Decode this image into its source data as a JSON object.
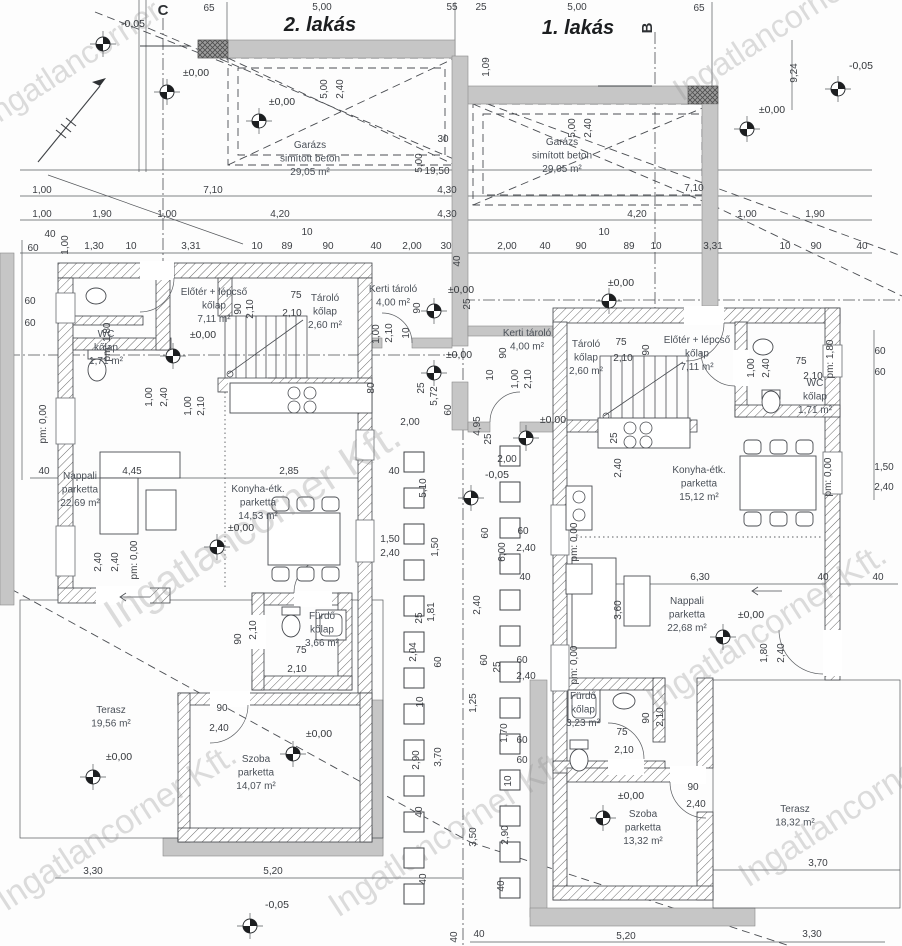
{
  "drawing": {
    "watermark_text": "Ingatlancorner Kft.",
    "units": [
      {
        "label": "2. lakás",
        "x": 320,
        "y": 31
      },
      {
        "label": "1. lakás",
        "x": 578,
        "y": 34
      }
    ],
    "section_markers": [
      {
        "t": "C",
        "x": 163,
        "y": 15,
        "r": 0,
        "line": [
          140,
          46,
          190,
          46
        ]
      },
      {
        "t": "B",
        "x": 652,
        "y": 28,
        "r": -90,
        "line": [
          598,
          86,
          652,
          86
        ]
      }
    ]
  },
  "rooms": [
    {
      "lines": [
        "Garázs",
        "simított beton",
        "29,05 m²"
      ],
      "x": 310,
      "y": 148
    },
    {
      "lines": [
        "Garázs",
        "simított beton",
        "29,05 m²"
      ],
      "x": 562,
      "y": 145
    },
    {
      "lines": [
        "Előtér + lépcső",
        "kőlap",
        "7,11 m²"
      ],
      "x": 214,
      "y": 295
    },
    {
      "lines": [
        "Előtér + lépcső",
        "kőlap",
        "7,11 m²"
      ],
      "x": 697,
      "y": 343
    },
    {
      "lines": [
        "WC",
        "kőlap",
        "1,71 m²"
      ],
      "x": 106,
      "y": 337
    },
    {
      "lines": [
        "WC",
        "kőlap",
        "1,71 m²"
      ],
      "x": 815,
      "y": 386
    },
    {
      "lines": [
        "Tároló",
        "kőlap",
        "2,60 m²"
      ],
      "x": 325,
      "y": 301
    },
    {
      "lines": [
        "Tároló",
        "kőlap",
        "2,60 m²"
      ],
      "x": 586,
      "y": 347
    },
    {
      "lines": [
        "Kerti tároló",
        "4,00 m²"
      ],
      "x": 393,
      "y": 292
    },
    {
      "lines": [
        "Kerti tároló",
        "4,00 m²"
      ],
      "x": 527,
      "y": 336
    },
    {
      "lines": [
        "Konyha-étk.",
        "parketta",
        "14,53 m²"
      ],
      "x": 258,
      "y": 492
    },
    {
      "lines": [
        "Konyha-étk.",
        "parketta",
        "15,12 m²"
      ],
      "x": 699,
      "y": 473
    },
    {
      "lines": [
        "Nappali",
        "parketta",
        "22,69 m²"
      ],
      "x": 80,
      "y": 479
    },
    {
      "lines": [
        "Nappali",
        "parketta",
        "22,68 m²"
      ],
      "x": 687,
      "y": 604
    },
    {
      "lines": [
        "Fürdő",
        "kőlap",
        "3,66 m²"
      ],
      "x": 322,
      "y": 619
    },
    {
      "lines": [
        "Fürdő",
        "kőlap",
        "3,23 m²"
      ],
      "x": 583,
      "y": 699
    },
    {
      "lines": [
        "Szoba",
        "parketta",
        "14,07 m²"
      ],
      "x": 256,
      "y": 762
    },
    {
      "lines": [
        "Szoba",
        "parketta",
        "13,32 m²"
      ],
      "x": 643,
      "y": 817
    },
    {
      "lines": [
        "Terasz",
        "19,56 m²"
      ],
      "x": 111,
      "y": 713
    },
    {
      "lines": [
        "Terasz",
        "18,32 m²"
      ],
      "x": 795,
      "y": 812
    }
  ],
  "levels": [
    {
      "t": "-0,05",
      "lx": 133,
      "ly": 27,
      "mx": 103,
      "my": 44
    },
    {
      "t": "±0,00",
      "lx": 196,
      "ly": 76,
      "mx": 167,
      "my": 92
    },
    {
      "t": "±0,00",
      "lx": 282,
      "ly": 105,
      "mx": 259,
      "my": 121
    },
    {
      "t": "±0,00",
      "lx": 772,
      "ly": 113,
      "mx": 747,
      "my": 129
    },
    {
      "t": "-0,05",
      "lx": 861,
      "ly": 69,
      "mx": 838,
      "my": 89
    },
    {
      "t": "±0,00",
      "lx": 621,
      "ly": 286,
      "mx": 609,
      "my": 301
    },
    {
      "t": "±0,00",
      "lx": 203,
      "ly": 338,
      "mx": 173,
      "my": 356
    },
    {
      "t": "±0,00",
      "lx": 461,
      "ly": 293,
      "mx": 434,
      "my": 311
    },
    {
      "t": "±0,00",
      "lx": 459,
      "ly": 358,
      "mx": 434,
      "my": 373
    },
    {
      "t": "±0,00",
      "lx": 553,
      "ly": 423,
      "mx": 526,
      "my": 438
    },
    {
      "t": "-0,05",
      "lx": 497,
      "ly": 478,
      "mx": 471,
      "my": 498
    },
    {
      "t": "±0,00",
      "lx": 241,
      "ly": 531,
      "mx": 217,
      "my": 547
    },
    {
      "t": "±0,00",
      "lx": 751,
      "ly": 618,
      "mx": 723,
      "my": 637
    },
    {
      "t": "±0,00",
      "lx": 319,
      "ly": 737,
      "mx": 293,
      "my": 754
    },
    {
      "t": "±0,00",
      "lx": 119,
      "ly": 760,
      "mx": 93,
      "my": 777
    },
    {
      "t": "±0,00",
      "lx": 631,
      "ly": 799,
      "mx": 603,
      "my": 818
    },
    {
      "t": "-0,05",
      "lx": 277,
      "ly": 908,
      "mx": 250,
      "my": 926
    }
  ],
  "dims": [
    {
      "t": "65",
      "x": 209,
      "y": 11
    },
    {
      "t": "5,00",
      "x": 322,
      "y": 10
    },
    {
      "t": "55",
      "x": 452,
      "y": 10
    },
    {
      "t": "25",
      "x": 481,
      "y": 10
    },
    {
      "t": "5,00",
      "x": 577,
      "y": 10
    },
    {
      "t": "65",
      "x": 699,
      "y": 11
    },
    {
      "t": "1,09",
      "x": 489,
      "y": 67,
      "r": 1
    },
    {
      "t": "9,24",
      "x": 797,
      "y": 73,
      "r": 1
    },
    {
      "t": "5,00",
      "x": 327,
      "y": 89,
      "r": 1
    },
    {
      "t": "2,40",
      "x": 343,
      "y": 89,
      "r": 1
    },
    {
      "t": "5,00",
      "x": 575,
      "y": 128,
      "r": 1
    },
    {
      "t": "2,40",
      "x": 591,
      "y": 128,
      "r": 1
    },
    {
      "t": "30",
      "x": 443,
      "y": 142
    },
    {
      "t": "5,00",
      "x": 422,
      "y": 163,
      "r": 1
    },
    {
      "t": "19,50",
      "x": 437,
      "y": 174
    },
    {
      "t": "40",
      "x": 460,
      "y": 261,
      "r": 1
    },
    {
      "t": "1,00",
      "x": 42,
      "y": 193
    },
    {
      "t": "7,10",
      "x": 213,
      "y": 193
    },
    {
      "t": "4,30",
      "x": 447,
      "y": 193
    },
    {
      "t": "7,10",
      "x": 694,
      "y": 191
    },
    {
      "t": "1,00",
      "x": 42,
      "y": 217
    },
    {
      "t": "1,90",
      "x": 102,
      "y": 217
    },
    {
      "t": "1,00",
      "x": 167,
      "y": 217
    },
    {
      "t": "4,20",
      "x": 280,
      "y": 217
    },
    {
      "t": "4,30",
      "x": 447,
      "y": 217
    },
    {
      "t": "4,20",
      "x": 637,
      "y": 217
    },
    {
      "t": "1,00",
      "x": 747,
      "y": 217
    },
    {
      "t": "1,90",
      "x": 815,
      "y": 217
    },
    {
      "t": "60",
      "x": 33,
      "y": 251
    },
    {
      "t": "40",
      "x": 50,
      "y": 237
    },
    {
      "t": "1,00",
      "x": 68,
      "y": 245,
      "r": 1
    },
    {
      "t": "1,30",
      "x": 94,
      "y": 249
    },
    {
      "t": "10",
      "x": 131,
      "y": 249
    },
    {
      "t": "3,31",
      "x": 191,
      "y": 249
    },
    {
      "t": "10",
      "x": 257,
      "y": 249
    },
    {
      "t": "89",
      "x": 287,
      "y": 249
    },
    {
      "t": "10",
      "x": 307,
      "y": 235
    },
    {
      "t": "90",
      "x": 328,
      "y": 249
    },
    {
      "t": "40",
      "x": 376,
      "y": 249
    },
    {
      "t": "2,00",
      "x": 412,
      "y": 249
    },
    {
      "t": "30",
      "x": 446,
      "y": 249
    },
    {
      "t": "2,00",
      "x": 507,
      "y": 249
    },
    {
      "t": "40",
      "x": 545,
      "y": 249
    },
    {
      "t": "90",
      "x": 581,
      "y": 249
    },
    {
      "t": "10",
      "x": 604,
      "y": 235
    },
    {
      "t": "89",
      "x": 629,
      "y": 249
    },
    {
      "t": "10",
      "x": 656,
      "y": 249
    },
    {
      "t": "3,31",
      "x": 713,
      "y": 249
    },
    {
      "t": "10",
      "x": 785,
      "y": 249
    },
    {
      "t": "90",
      "x": 816,
      "y": 249
    },
    {
      "t": "40",
      "x": 862,
      "y": 249
    },
    {
      "t": "60",
      "x": 30,
      "y": 304
    },
    {
      "t": "60",
      "x": 30,
      "y": 326
    },
    {
      "t": "pm: 0,00",
      "x": 46,
      "y": 424,
      "r": 1
    },
    {
      "t": "40",
      "x": 44,
      "y": 474
    },
    {
      "t": "4,45",
      "x": 132,
      "y": 474
    },
    {
      "t": "2,85",
      "x": 289,
      "y": 474
    },
    {
      "t": "2,40",
      "x": 101,
      "y": 562,
      "r": 1
    },
    {
      "t": "2,40",
      "x": 118,
      "y": 562,
      "r": 1
    },
    {
      "t": "pm: 0,00",
      "x": 137,
      "y": 560,
      "r": 1
    },
    {
      "t": "75",
      "x": 296,
      "y": 298
    },
    {
      "t": "2,10",
      "x": 292,
      "y": 316
    },
    {
      "t": "90",
      "x": 241,
      "y": 309,
      "r": 1
    },
    {
      "t": "2,10",
      "x": 253,
      "y": 309,
      "r": 1
    },
    {
      "t": "pm: 1,80",
      "x": 110,
      "y": 342,
      "r": 1
    },
    {
      "t": "1,00",
      "x": 152,
      "y": 397,
      "r": 1
    },
    {
      "t": "2,40",
      "x": 167,
      "y": 397,
      "r": 1
    },
    {
      "t": "1,00",
      "x": 191,
      "y": 406,
      "r": 1
    },
    {
      "t": "2,10",
      "x": 204,
      "y": 406,
      "r": 1
    },
    {
      "t": "90",
      "x": 222,
      "y": 711
    },
    {
      "t": "2,40",
      "x": 219,
      "y": 731
    },
    {
      "t": "75",
      "x": 301,
      "y": 653
    },
    {
      "t": "2,10",
      "x": 297,
      "y": 672
    },
    {
      "t": "90",
      "x": 241,
      "y": 639,
      "r": 1
    },
    {
      "t": "2,10",
      "x": 256,
      "y": 630,
      "r": 1
    },
    {
      "t": "90",
      "x": 420,
      "y": 308,
      "r": 1
    },
    {
      "t": "10",
      "x": 409,
      "y": 333,
      "r": 1
    },
    {
      "t": "1,00",
      "x": 379,
      "y": 334,
      "r": 1
    },
    {
      "t": "2,10",
      "x": 392,
      "y": 333,
      "r": 1
    },
    {
      "t": "80",
      "x": 374,
      "y": 388,
      "r": 1
    },
    {
      "t": "25",
      "x": 424,
      "y": 388,
      "r": 1
    },
    {
      "t": "5,72",
      "x": 437,
      "y": 396,
      "r": 1
    },
    {
      "t": "2,00",
      "x": 410,
      "y": 425
    },
    {
      "t": "25",
      "x": 470,
      "y": 304,
      "r": 1
    },
    {
      "t": "90",
      "x": 506,
      "y": 353,
      "r": 1
    },
    {
      "t": "10",
      "x": 493,
      "y": 375,
      "r": 1
    },
    {
      "t": "1,00",
      "x": 518,
      "y": 379,
      "r": 1
    },
    {
      "t": "2,10",
      "x": 531,
      "y": 379,
      "r": 1
    },
    {
      "t": "4,95",
      "x": 480,
      "y": 426,
      "r": 1
    },
    {
      "t": "60",
      "x": 451,
      "y": 410,
      "r": 1
    },
    {
      "t": "2,00",
      "x": 507,
      "y": 462
    },
    {
      "t": "25",
      "x": 491,
      "y": 439,
      "r": 1
    },
    {
      "t": "40",
      "x": 394,
      "y": 474
    },
    {
      "t": "5,10",
      "x": 426,
      "y": 488,
      "r": 1
    },
    {
      "t": "1,50",
      "x": 390,
      "y": 542
    },
    {
      "t": "2,40",
      "x": 390,
      "y": 556
    },
    {
      "t": "1,50",
      "x": 438,
      "y": 547,
      "r": 1
    },
    {
      "t": "25",
      "x": 422,
      "y": 618,
      "r": 1
    },
    {
      "t": "1,81",
      "x": 434,
      "y": 612,
      "r": 1
    },
    {
      "t": "2,04",
      "x": 416,
      "y": 652,
      "r": 1
    },
    {
      "t": "60",
      "x": 441,
      "y": 662,
      "r": 1
    },
    {
      "t": "10",
      "x": 423,
      "y": 702,
      "r": 1
    },
    {
      "t": "2,90",
      "x": 419,
      "y": 760,
      "r": 1
    },
    {
      "t": "3,70",
      "x": 441,
      "y": 757,
      "r": 1
    },
    {
      "t": "40",
      "x": 422,
      "y": 812,
      "r": 1
    },
    {
      "t": "40",
      "x": 426,
      "y": 879,
      "r": 1
    },
    {
      "t": "60",
      "x": 488,
      "y": 533,
      "r": 1
    },
    {
      "t": "6,00",
      "x": 505,
      "y": 552,
      "r": 1
    },
    {
      "t": "2,40",
      "x": 480,
      "y": 605,
      "r": 1
    },
    {
      "t": "60",
      "x": 487,
      "y": 660,
      "r": 1
    },
    {
      "t": "25",
      "x": 500,
      "y": 667,
      "r": 1
    },
    {
      "t": "1,25",
      "x": 476,
      "y": 703,
      "r": 1
    },
    {
      "t": "1,70",
      "x": 507,
      "y": 733,
      "r": 1
    },
    {
      "t": "10",
      "x": 511,
      "y": 781,
      "r": 1
    },
    {
      "t": "3,50",
      "x": 476,
      "y": 837,
      "r": 1
    },
    {
      "t": "2,90",
      "x": 508,
      "y": 835,
      "r": 1
    },
    {
      "t": "40",
      "x": 504,
      "y": 886,
      "r": 1
    },
    {
      "t": "40",
      "x": 457,
      "y": 937,
      "r": 1
    },
    {
      "t": "40",
      "x": 479,
      "y": 937
    },
    {
      "t": "60",
      "x": 523,
      "y": 534
    },
    {
      "t": "2,40",
      "x": 526,
      "y": 551
    },
    {
      "t": "40",
      "x": 525,
      "y": 580
    },
    {
      "t": "60",
      "x": 522,
      "y": 663
    },
    {
      "t": "2,40",
      "x": 526,
      "y": 679
    },
    {
      "t": "60",
      "x": 522,
      "y": 743
    },
    {
      "t": "60",
      "x": 522,
      "y": 763
    },
    {
      "t": "6,30",
      "x": 700,
      "y": 580
    },
    {
      "t": "40",
      "x": 823,
      "y": 580
    },
    {
      "t": "40",
      "x": 878,
      "y": 580
    },
    {
      "t": "3,60",
      "x": 621,
      "y": 610,
      "r": 1
    },
    {
      "t": "1,80",
      "x": 767,
      "y": 653,
      "r": 1
    },
    {
      "t": "2,40",
      "x": 784,
      "y": 653,
      "r": 1
    },
    {
      "t": "pm: 0,00",
      "x": 577,
      "y": 542,
      "r": 1
    },
    {
      "t": "pm: 0,00",
      "x": 577,
      "y": 665,
      "r": 1
    },
    {
      "t": "pm: 0,00",
      "x": 831,
      "y": 477,
      "r": 1
    },
    {
      "t": "2,40",
      "x": 621,
      "y": 468,
      "r": 1
    },
    {
      "t": "25",
      "x": 617,
      "y": 438,
      "r": 1
    },
    {
      "t": "60",
      "x": 880,
      "y": 354
    },
    {
      "t": "60",
      "x": 880,
      "y": 375
    },
    {
      "t": "1,50",
      "x": 884,
      "y": 470
    },
    {
      "t": "2,40",
      "x": 884,
      "y": 490
    },
    {
      "t": "75",
      "x": 621,
      "y": 345
    },
    {
      "t": "2,10",
      "x": 623,
      "y": 361
    },
    {
      "t": "90",
      "x": 649,
      "y": 350,
      "r": 1
    },
    {
      "t": "1,00",
      "x": 754,
      "y": 368,
      "r": 1
    },
    {
      "t": "2,40",
      "x": 769,
      "y": 368,
      "r": 1
    },
    {
      "t": "75",
      "x": 801,
      "y": 364
    },
    {
      "t": "2,10",
      "x": 813,
      "y": 379
    },
    {
      "t": "pm: 1,80",
      "x": 833,
      "y": 359,
      "r": 1
    },
    {
      "t": "75",
      "x": 622,
      "y": 735
    },
    {
      "t": "2,10",
      "x": 624,
      "y": 753
    },
    {
      "t": "90",
      "x": 649,
      "y": 718,
      "r": 1
    },
    {
      "t": "2,10",
      "x": 663,
      "y": 717,
      "r": 1
    },
    {
      "t": "90",
      "x": 693,
      "y": 790
    },
    {
      "t": "2,40",
      "x": 696,
      "y": 807
    },
    {
      "t": "3,30",
      "x": 93,
      "y": 874
    },
    {
      "t": "5,20",
      "x": 273,
      "y": 874
    },
    {
      "t": "5,20",
      "x": 626,
      "y": 939
    },
    {
      "t": "3,30",
      "x": 812,
      "y": 937
    },
    {
      "t": "3,70",
      "x": 818,
      "y": 866
    }
  ],
  "watermarks": [
    {
      "t": "Ingatlancorner",
      "x": -8,
      "y": 128,
      "s": 32
    },
    {
      "t": "Ingatlancorner Kft.",
      "x": 682,
      "y": 102,
      "s": 32
    },
    {
      "t": "Ingatlancorner Kft.",
      "x": 116,
      "y": 630,
      "s": 42
    },
    {
      "t": "Ingatlancorner Kft.",
      "x": 6,
      "y": 912,
      "s": 34
    },
    {
      "t": "Ingatlancorner Kft.",
      "x": 338,
      "y": 918,
      "s": 34
    },
    {
      "t": "Ingatlancorner Kft.",
      "x": 656,
      "y": 712,
      "s": 34
    },
    {
      "t": "Ingatlancorner Kft.",
      "x": 748,
      "y": 888,
      "s": 34
    }
  ],
  "columns": {
    "size": 20,
    "rows": [
      {
        "x": 414,
        "y0": 452,
        "n": 13,
        "dy": 36
      },
      {
        "x": 510,
        "y0": 446,
        "n": 13,
        "dy": 36
      }
    ]
  }
}
